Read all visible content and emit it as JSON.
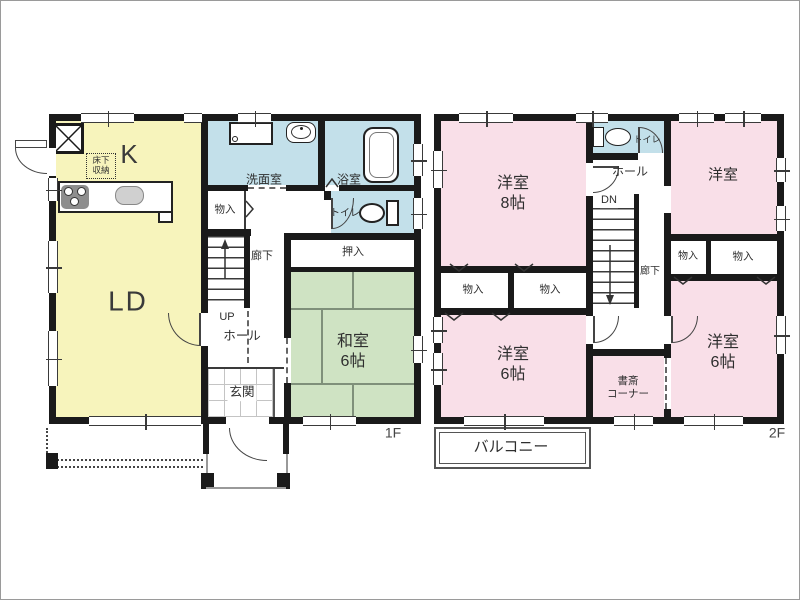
{
  "floor_plan": {
    "f1": {
      "label": "1F",
      "kitchen": "K",
      "living_dining": "LD",
      "underfloor_storage": "床下\n収納",
      "washroom": "洗面室",
      "bathroom": "浴室",
      "toilet": "トイレ",
      "storage": "物入",
      "corridor": "廊下",
      "stairs_up": "UP",
      "hall": "ホール",
      "entrance": "玄関",
      "closet": "押入",
      "japanese_room": "和室\n6帖"
    },
    "f2": {
      "label": "2F",
      "bedroom_8": "洋室\n8帖",
      "toilet": "トイレ",
      "hall": "ホール",
      "stairs_down": "DN",
      "corridor": "廊下",
      "bedroom_ne": "洋室",
      "storage1": "物入",
      "storage2": "物入",
      "storage3": "物入",
      "storage4": "物入",
      "bedroom_6_sw": "洋室\n6帖",
      "bedroom_6_se": "洋室\n6帖",
      "study_corner": "書斎\nコーナー",
      "balcony": "バルコニー"
    },
    "colors": {
      "wall": "#1a1a1a",
      "ldk_yellow": "#f7f4bc",
      "wet_area_blue": "#c3e0ea",
      "tatami_green": "#cfe3c3",
      "bedroom_pink": "#f9dfe8"
    }
  }
}
